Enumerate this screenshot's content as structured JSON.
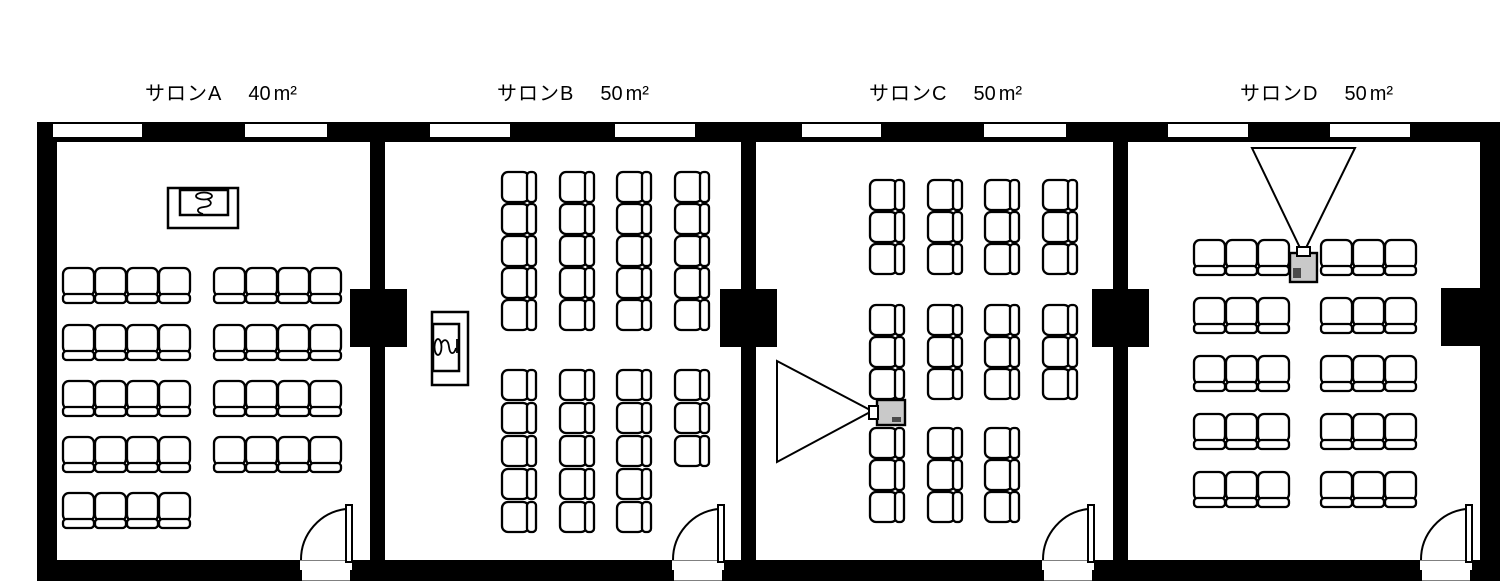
{
  "page": {
    "background": "#ffffff",
    "kind": "meeting-room-floor-plan"
  },
  "plan": {
    "canvas": {
      "w": 1500,
      "h": 581
    },
    "colors": {
      "wall": "#000000",
      "floor": "#ffffff",
      "stroke": "#000000",
      "projector_body": "#c9c9c9",
      "projector_dark": "#4a4a4a"
    },
    "structure": {
      "walls": [
        {
          "name": "wall-top",
          "x": 37,
          "y": 122,
          "w": 1463,
          "h": 20
        },
        {
          "name": "wall-bottom",
          "x": 37,
          "y": 560,
          "w": 1463,
          "h": 21
        },
        {
          "name": "wall-left",
          "x": 37,
          "y": 122,
          "w": 20,
          "h": 459
        },
        {
          "name": "wall-right",
          "x": 1480,
          "y": 122,
          "w": 20,
          "h": 459
        }
      ],
      "dividers": [
        {
          "name": "wall-between-a-b",
          "x": 370,
          "y": 140,
          "w": 15,
          "h": 422
        },
        {
          "name": "wall-between-b-c",
          "x": 741,
          "y": 140,
          "w": 15,
          "h": 422
        },
        {
          "name": "wall-between-c-d",
          "x": 1113,
          "y": 140,
          "w": 15,
          "h": 422
        }
      ],
      "pillars": [
        {
          "x": 350,
          "y": 289,
          "w": 57,
          "h": 58
        },
        {
          "x": 720,
          "y": 289,
          "w": 57,
          "h": 58
        },
        {
          "x": 1092,
          "y": 289,
          "w": 57,
          "h": 58
        },
        {
          "x": 1441,
          "y": 288,
          "w": 39,
          "h": 58
        }
      ]
    },
    "rooms": [
      {
        "id": "salon-a",
        "name": "サロンA",
        "area_value": "40",
        "area_unit": "m²",
        "label_pos": {
          "x": 145,
          "y": 84
        },
        "windows": [
          {
            "x": 53,
            "w": 89
          },
          {
            "x": 245,
            "w": 82
          }
        ],
        "door": {
          "x1": 300,
          "x2": 352
        },
        "podium": {
          "icon": "microphone-icon",
          "orientation": "horizontal",
          "outer": {
            "x": 168,
            "y": 188,
            "w": 70,
            "h": 40
          },
          "inner": {
            "x": 180,
            "y": 190,
            "w": 48,
            "h": 25
          },
          "mic": {
            "cx": 204,
            "cy": 203,
            "rotate": 0
          }
        },
        "seating": {
          "orientation": "up",
          "chair": {
            "w": 31,
            "seat_h": 28,
            "back_h": 9
          },
          "blocks": [
            {
              "cols": [
                63,
                95,
                127,
                159
              ],
              "rows": [
                268,
                325,
                381,
                437,
                493
              ]
            },
            {
              "cols": [
                214,
                246,
                278,
                310
              ],
              "rows": [
                268,
                325,
                381,
                437
              ]
            }
          ]
        }
      },
      {
        "id": "salon-b",
        "name": "サロンB",
        "area_value": "50",
        "area_unit": "m²",
        "label_pos": {
          "x": 497,
          "y": 84
        },
        "windows": [
          {
            "x": 430,
            "w": 80
          },
          {
            "x": 615,
            "w": 80
          }
        ],
        "door": {
          "x1": 672,
          "x2": 724
        },
        "podium": {
          "icon": "microphone-icon",
          "orientation": "vertical",
          "outer": {
            "x": 432,
            "y": 312,
            "w": 36,
            "h": 73
          },
          "inner": {
            "x": 433,
            "y": 324,
            "w": 26,
            "h": 47
          },
          "mic": {
            "cx": 445,
            "cy": 347,
            "rotate": -90
          }
        },
        "seating": {
          "orientation": "left",
          "chair": {
            "seat_w": 27,
            "h": 30,
            "back_w": 9
          },
          "blocks": [
            {
              "cols": [
                502,
                560,
                617,
                675
              ],
              "rows": [
                172,
                204,
                236,
                268,
                300
              ]
            },
            {
              "cols": [
                502,
                560,
                617
              ],
              "rows": [
                370,
                403,
                436,
                469,
                502
              ]
            },
            {
              "cols": [
                675
              ],
              "rows": [
                370,
                403,
                436
              ]
            }
          ]
        }
      },
      {
        "id": "salon-c",
        "name": "サロンC",
        "area_value": "50",
        "area_unit": "m²",
        "label_pos": {
          "x": 869,
          "y": 84
        },
        "windows": [
          {
            "x": 802,
            "w": 79
          },
          {
            "x": 984,
            "w": 82
          }
        ],
        "door": {
          "x1": 1042,
          "x2": 1094
        },
        "projector": {
          "icon": "projector-icon",
          "facing": "left",
          "body": {
            "x": 877,
            "y": 400,
            "w": 28,
            "h": 25
          },
          "cone": [
            [
              777,
              361
            ],
            [
              777,
              462
            ],
            [
              872,
              411
            ]
          ]
        },
        "seating": {
          "orientation": "left",
          "chair": {
            "seat_w": 27,
            "h": 30,
            "back_w": 9
          },
          "blocks": [
            {
              "cols": [
                870,
                928,
                985,
                1043
              ],
              "rows": [
                180,
                212,
                244
              ]
            },
            {
              "cols": [
                870,
                928,
                985,
                1043
              ],
              "rows": [
                305,
                337,
                369
              ]
            },
            {
              "cols": [
                870,
                928,
                985
              ],
              "rows": [
                428,
                460,
                492
              ]
            }
          ]
        }
      },
      {
        "id": "salon-d",
        "name": "サロンD",
        "area_value": "50",
        "area_unit": "m²",
        "label_pos": {
          "x": 1240,
          "y": 84
        },
        "windows": [
          {
            "x": 1168,
            "w": 80
          },
          {
            "x": 1330,
            "w": 80
          }
        ],
        "door": {
          "x1": 1420,
          "x2": 1472
        },
        "projector": {
          "icon": "projector-icon",
          "facing": "up",
          "body": {
            "x": 1290,
            "y": 253,
            "w": 27,
            "h": 29
          },
          "cone": [
            [
              1252,
              148
            ],
            [
              1355,
              148
            ],
            [
              1303,
              254
            ]
          ]
        },
        "seating": {
          "orientation": "up",
          "chair": {
            "w": 31,
            "seat_h": 28,
            "back_h": 9
          },
          "blocks": [
            {
              "cols": [
                1194,
                1226,
                1258,
                1321,
                1353,
                1385
              ],
              "rows": [
                240,
                298,
                356,
                414,
                472
              ]
            }
          ]
        }
      }
    ]
  }
}
